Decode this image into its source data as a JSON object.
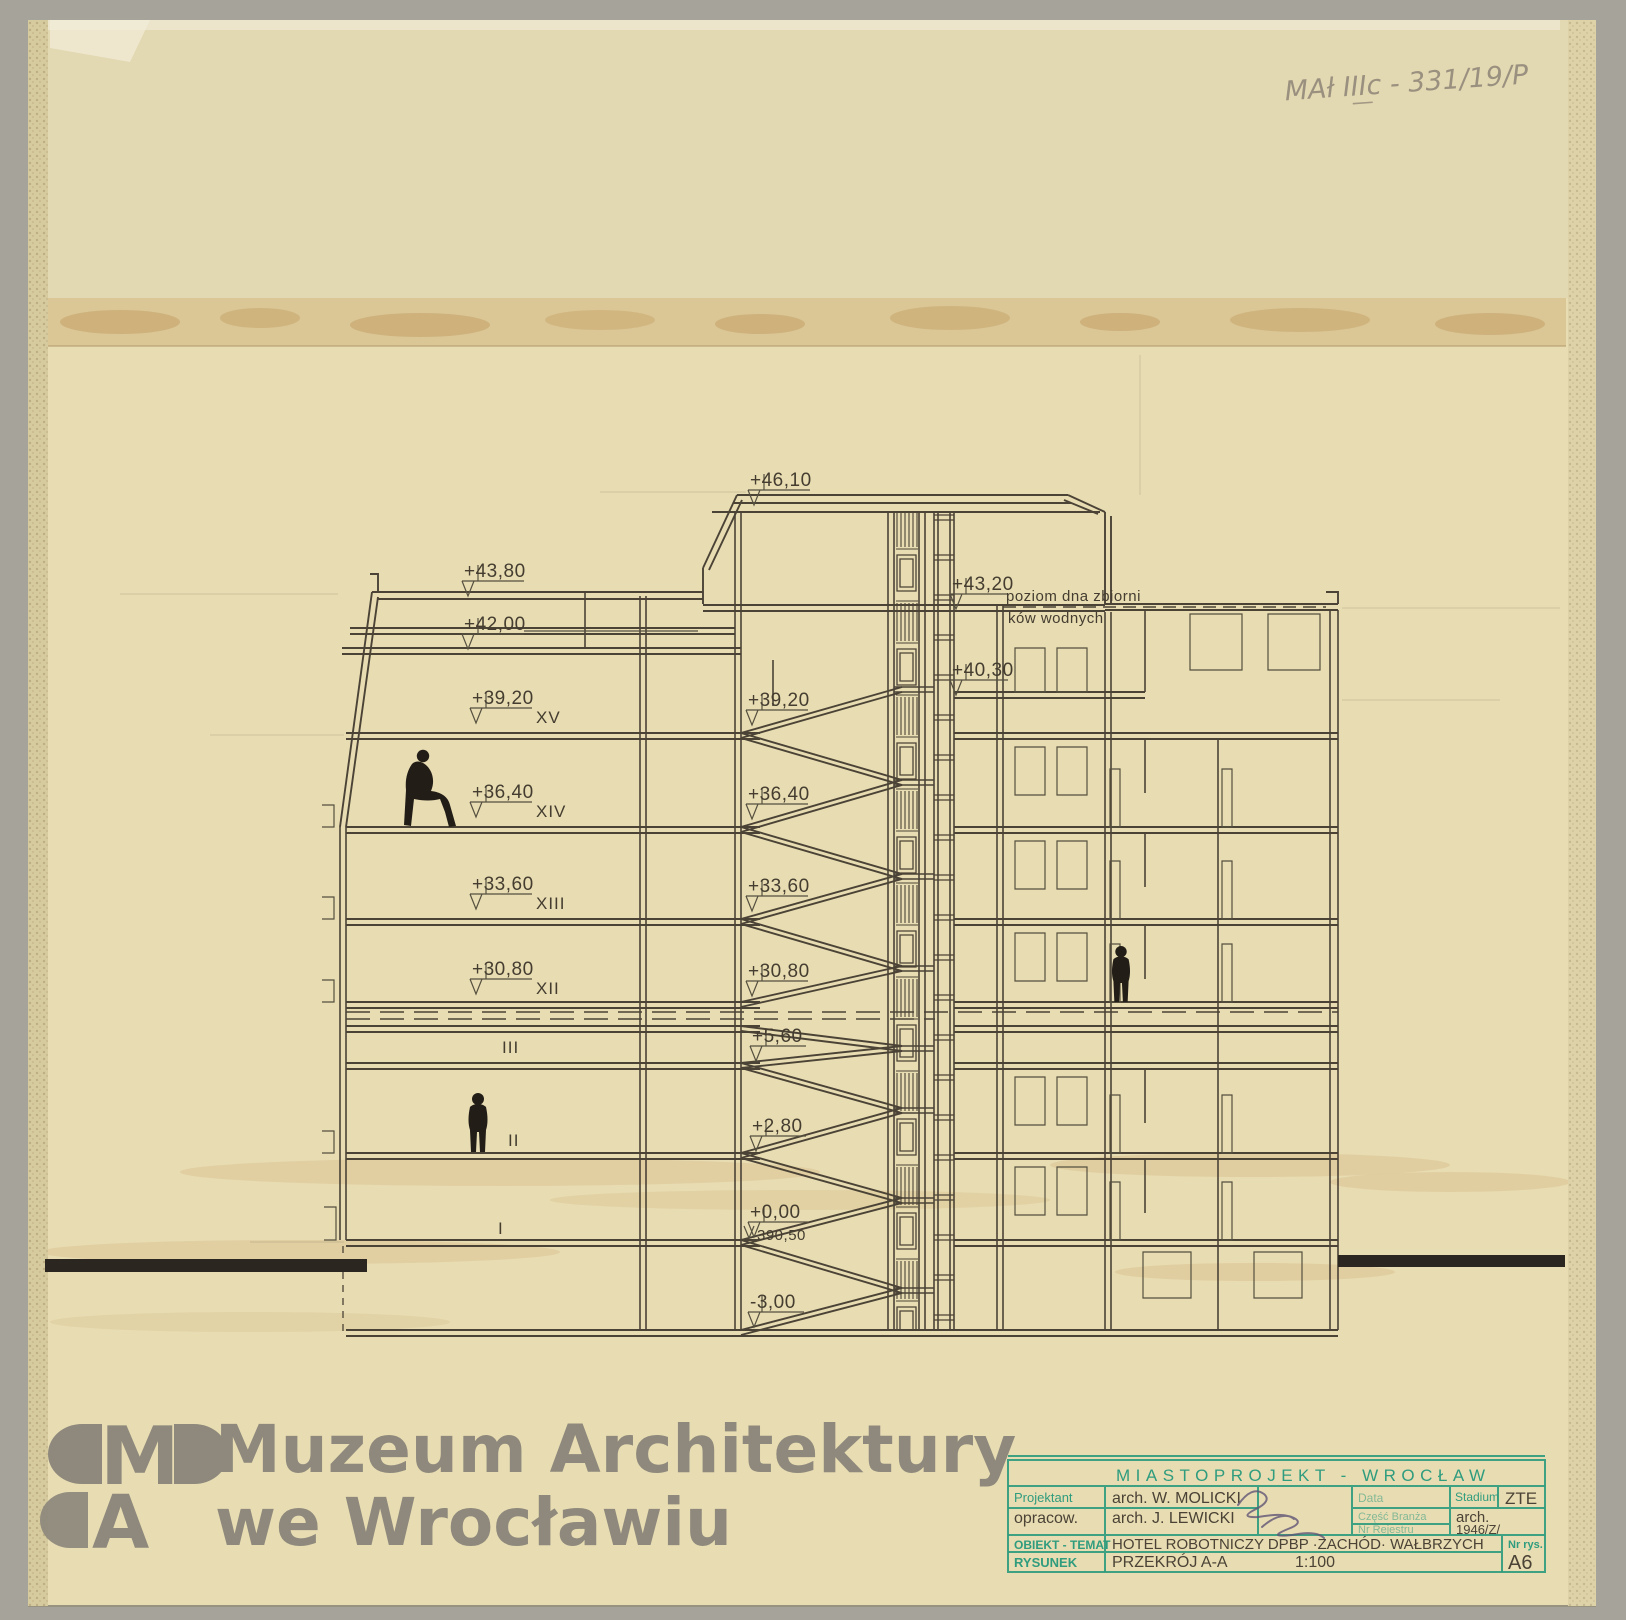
{
  "archive": {
    "inscription": "MAł IIIc - 331/19/P"
  },
  "levels": {
    "v4610": "+46,10",
    "v4380": "+43,80",
    "v4200": "+42,00",
    "v3920": "+39,20",
    "v3640": "+36,40",
    "v3360": "+33,60",
    "v3080": "+30,80",
    "v560": "+5,60",
    "v280": "+2,80",
    "v000": "+0,00",
    "vabs": "390,50",
    "vm300": "-3,00",
    "v4320": "+43,20",
    "v4030": "+40,30"
  },
  "floors": {
    "f15": "XV",
    "f14": "XIV",
    "f13": "XIII",
    "f12": "XII",
    "f3": "III",
    "f2": "II",
    "f1": "I"
  },
  "notes": {
    "tank1": "poziom dna zbiorni",
    "tank2": "ków wodnych"
  },
  "watermark": {
    "logo_m": "M",
    "logo_a": "A",
    "line1": "Muzeum Architektury",
    "line2": "we Wrocławiu"
  },
  "stamp": {
    "header": "MIASTOPROJEKT - WROCŁAW",
    "projektant_label": "Projektant",
    "projektant_value": "arch. W. MOLICKI",
    "opracow_label": "opracow.",
    "opracow_value": "arch. J. LEWICKI",
    "data_label": "Data",
    "czesc_label": "Część  Branża",
    "nr_rejestru_label": "Nr Rejestru",
    "stadium_label": "Stadium",
    "stadium_value": "ZTE",
    "branza_value": "arch.",
    "nr_value": "1946/Z/",
    "obiekt_label": "OBIEKT - TEMAT",
    "obiekt_value": "HOTEL ROBOTNICZY DPBP ·ZACHÓD· WAŁBRZYCH",
    "rysunek_label": "RYSUNEK",
    "rysunek_value": "PRZEKRÓJ A-A",
    "scale": "1:100",
    "nr_rys_label": "Nr rys.",
    "nr_rys_value": "A6"
  }
}
